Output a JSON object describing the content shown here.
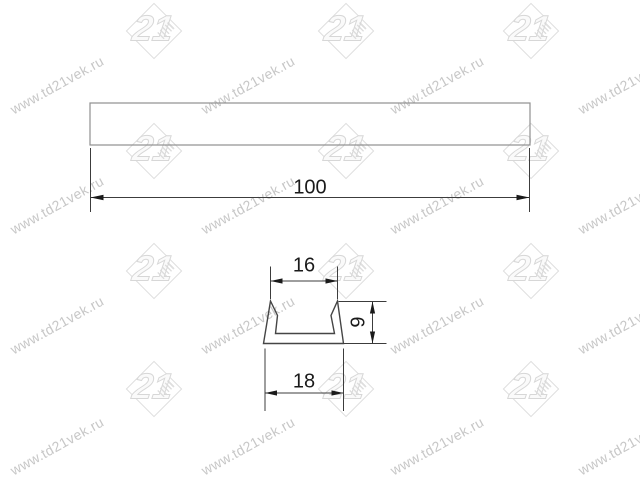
{
  "watermark": {
    "text": "www.td21vek.ru",
    "logo_text": "21"
  },
  "drawing": {
    "front_view": {
      "length_label": "100"
    },
    "section_view": {
      "top_width_label": "16",
      "height_label": "9",
      "bottom_width_label": "18"
    }
  },
  "colors": {
    "dimension_line": "#3c3c3c",
    "profile_line": "#454545",
    "front_view_line": "#8f8f8f",
    "label_text": "#1a1a1a",
    "watermark_text": "#c7c7c7",
    "watermark_logo": "#dedede",
    "background": "#ffffff"
  }
}
